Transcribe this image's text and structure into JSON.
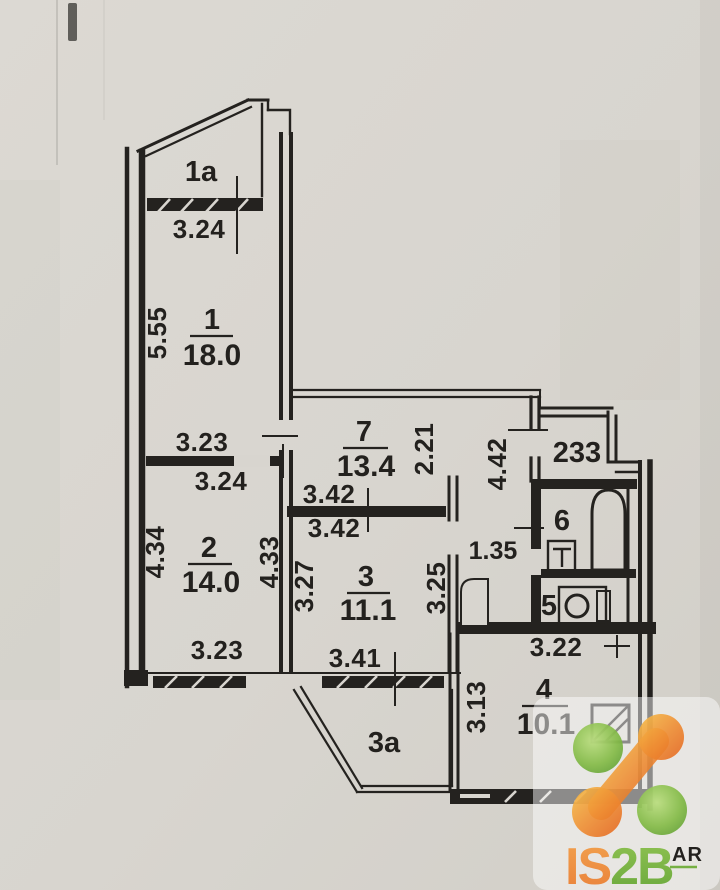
{
  "palette": {
    "paper": "#d8d5cf",
    "ink": "#24221f",
    "logo_green": "#76b043",
    "logo_orange": "#e8772e"
  },
  "unit_number": "233",
  "rooms": {
    "r1a": {
      "number": "1a"
    },
    "r1": {
      "number": "1",
      "area": "18.0"
    },
    "r2": {
      "number": "2",
      "area": "14.0"
    },
    "r3": {
      "number": "3",
      "area": "11.1"
    },
    "r3a": {
      "number": "3a"
    },
    "r4": {
      "number": "4",
      "area": "10.1"
    },
    "r5": {
      "number": "5"
    },
    "r6": {
      "number": "6"
    },
    "r7": {
      "number": "7",
      "area": "13.4"
    }
  },
  "dims": {
    "balcony_1a_width": "3.24",
    "r1_height": "5.55",
    "r1_width": "3.23",
    "r2_top_width": "3.24",
    "r2_left_height": "4.34",
    "r2_right_height": "4.33",
    "r2_bottom_width": "3.23",
    "r7_inner_height": "2.21",
    "hall_height": "4.42",
    "r7_bottom_width": "3.42",
    "r3_top_width": "3.42",
    "r3_left_height": "3.27",
    "r3_right_height": "3.25",
    "r3_bottom_width": "3.41",
    "corridor_width": "1.35",
    "wc_width": "3.22",
    "r4_left_height": "3.13"
  },
  "watermark": {
    "part1": "IS",
    "part2": "2B",
    "superscript": "AR"
  }
}
